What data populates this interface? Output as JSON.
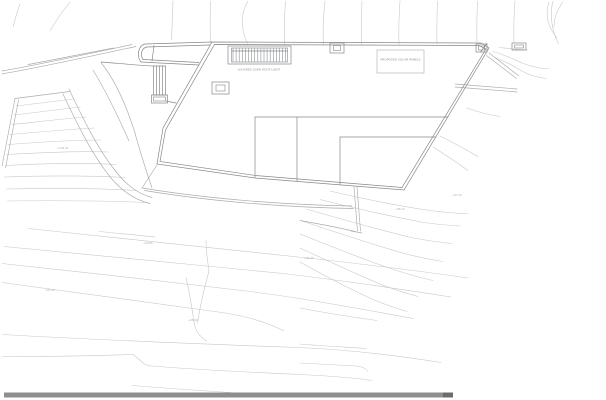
{
  "page": {
    "background": "#ffffff"
  },
  "colors": {
    "line_light": "#c6c8ca",
    "line_medium": "#a9acae",
    "line_dark": "#85888a",
    "text": "#8f9294",
    "scale_bar": "#8d8f8e",
    "scale_bar_end": "#6b6d6c"
  },
  "labels": {
    "louver_caption": "LOUVRES OVER ROOF LIGHT",
    "panel_label": "PROPOSED SOLAR PANELS",
    "levels": [
      {
        "x": 57,
        "y": 149,
        "t": "+104.20"
      },
      {
        "x": 143,
        "y": 244,
        "t": "+99.80"
      },
      {
        "x": 45,
        "y": 291,
        "t": "+97.20"
      },
      {
        "x": 188,
        "y": 321,
        "t": "+95.60"
      },
      {
        "x": 304,
        "y": 259,
        "t": "+96.40"
      },
      {
        "x": 452,
        "y": 196,
        "t": "+97.50"
      },
      {
        "x": 395,
        "y": 210,
        "t": "+98.10"
      }
    ]
  },
  "scale_bar": {
    "x": 4,
    "y": 392.5,
    "w": 449,
    "h": 5,
    "end_w": 10
  },
  "drawing": {
    "width": 606,
    "height": 400,
    "layers": [
      {
        "name": "contour-line",
        "color": "line_light",
        "width": 0.6,
        "paths": [
          "M20,4 C17,12 15,19.5 13,27",
          "M70,2 C62,12 55,22 50,31",
          "M173,1 C172.5,14 172,27 171.5,40",
          "M210.5,1 C210,14.5 210,28.5 210.5,42",
          "M248,1 C240.5,13 240.5,29 247.5,43.5",
          "M285.5,1 C284.5,15 284,29.5 284.5,44",
          "M325,1 C323.5,15 322.5,30 323.5,44.5",
          "M362,1 C361.5,15 361,30 361.5,44.5",
          "M400,1 C399,15 398.5,30 399,44.5",
          "M437.5,1 C437,15 436.5,29 437,43.5",
          "M477.5,1 C477,14 476.5,27.5 477,42",
          "M515,1 C514,14 513.5,27 514,42.5",
          "M553,1 C549.5,14 551.5,30 558.5,44",
          "M549,2 C545,13 547,26 557,38",
          "M563,2 C557,10 554,18 554,27",
          "M16,106 C34,104 54,101.5 74,99",
          "M14,115 C36,112.5 58,109.5 80,107",
          "M12,124.5 C36,122 61,119 86,117",
          "M10,134.5 C38,132 67,129.5 94,128",
          "M8,144.5 C41,142 73,140 101,140",
          "M6.5,154.5 C42,152.5 78,151 108,152",
          "M5,165.5 C44,163.5 82,162.5 116,164.5",
          "M4,177 C48,175.5 90,175.5 125,177.5",
          "M6,189 C52,188 97,188 135,190.5",
          "M7.5,201 C55,200.5 102,200.5 147,202.5",
          "M99,231.5 C119,233.5 138,235 155,237",
          "M28,228.5 C110,238 200,247 298,257 C358,263.5 420,271 468,278",
          "M4,246.5 C92,255.5 190,264 283,273.5 C343,280.5 403,289.5 451,297",
          "M2,263.5 C82,272 168,281.5 246,291 C300,297.5 360,309 414,318.5",
          "M2,282.5 C72,292 150,302.5 222,312.5 C248,316.5 268,322.5 284,331",
          "M2,334.5 C100,340 200,344 298,347.5 C350,349.5 400,356 441,362.5",
          "M2,356.5 C55,356.5 105,355.5 133,354.5 C141,359.5 142,365.5 152,366 C200,370 255,372.5 300,374.5 C330,376 356,378 372,380.5",
          "M132,385.5 C195,390.5 252,394 306,397",
          "M206,240.5 C206,251 207.5,261 209,271",
          "M186,277.5 C190,294 192,309 194,322",
          "M209,271 C203.5,291 199.5,309.5 197.5,323",
          "M194,322 C195,330 199,336.5 207,341",
          "M330,191 C362,198.5 396,205.5 430,210.5 C446,212.5 459,213.5 468,213.5",
          "M320,199.5 C356,208.5 391,216.5 424,222.5 C438,224.5 451,225.5 460,226",
          "M306,209 C341,219 378,229.5 411,237.5 C427,240.5 441,242.5 452,243.5",
          "M302,221 C335,232 368,243 399,252 C415,256.5 430,259.5 443,261.5",
          "M300,234 C330,246 360,258 389,268 C404,273 419,277.5 433,280.5",
          "M300,248 C328,261 355,273.5 381,284.5 C394,289.5 407,293.5 418,296.5",
          "M300,262 C325,276 349,288.5 373,299.5 C385,304.5 397,308.5 407,311.5",
          "M300,308 C326,313 351,317 377,320.5",
          "M300,344 C322,346 344,347 366,348.5",
          "M300,363 C320,364 339,365 356,366 C362,366.5 366,368.5 368,371.5",
          "M493,51.5 C504,54.5 514,59.5 522,63 C531,66.5 541,68.5 549,69",
          "M495,57.5 C505,61.5 513,65.5 520,70 C528,74.5 537,77.5 546,78.5",
          "M499,47.5 C509,48.5 518,49.5 528,50",
          "M440,136 C452,142 465,149 478,156.5",
          "M433,147 C445,154.5 457,162.5 468,170.5",
          "M467,108 C478,112 489,115 500,116.5"
        ]
      },
      {
        "name": "site-line",
        "color": "line_medium",
        "width": 0.65,
        "paths": [
          "M2,74 C42,67 92,56 136,46.5",
          "M2,71 C42,64 90,53.5 132,44.5",
          "M28,64.5 C56,59.5 86,53 114,48",
          "M101,62.5 C114,79 126,104 135,133",
          "M93,70 C104,88 117,114 129,141",
          "M135,133 C140,152 146,170 152,188",
          "M69,89 C80,112 96,147 117,173 C127,185.5 139,194 152,197.5",
          "M63,94 C74,117 90,152 111,178 C122,191 135,200 150,203.5",
          "M15,98.5 L2,166",
          "M18.5,100 L5.5,168",
          "M15,98.5 C34,96 53,93.5 70,91.5",
          "M157,165 L142,188",
          "M142,188 C212,199.5 290,205 352,206",
          "M144.5,190.5 C214,202 291,207.5 353.5,208.5",
          "M354,187 L357.5,231",
          "M357,187 L360.5,231",
          "M300,220.5 C325,225 343,228.5 355,231.5",
          "M351,231 L362,233",
          "M489,53 L519,76",
          "M486.5,55.5 L516.5,78.5",
          "M455,84 L517,89",
          "M455,87 L517,92"
        ]
      },
      {
        "name": "building-line",
        "color": "line_dark",
        "width": 0.7,
        "paths": [
          "M212,42 L481,43 L489,48 L404,190 L255,178 L157,164 L163,128 Z",
          "M214.5,44.5 L479,45.5 L486,49 L402,187.5 L255.5,175.5 L160,161.5 L165.5,130 Z",
          "M255,117 L448,117",
          "M255,117 L255,177.5",
          "M297,117 L297,181",
          "M340,137 L436,137",
          "M340,137 L340,184.5",
          "M145,44 L212,42",
          "M146.5,47 L210,45",
          "M141,62 L199,65",
          "M143,59.5 L199,62.5",
          "M145,44 C138.5,45.5 136,55.5 141,62",
          "M146.5,47 C141.5,48.5 140,54.5 143,59.5",
          "M154,45.5 L152,61",
          "M153.5,66 C140,65.5 120,63.5 101,62",
          "M153.5,66 L153.5,95",
          "M156.5,66 L156.5,95",
          "M159.5,66 L159.5,95",
          "M162.5,66 L162.5,95",
          "M165.5,66 L165.5,95",
          "M153.5,66 L165.5,66",
          "M153.5,95 L165.5,95",
          "M166,101 L176,103",
          "M487,43.5 L480.5,52",
          "M231.5,51 L287.5,51"
        ]
      }
    ],
    "rects": [
      {
        "name": "louver-box-outer",
        "x": 228,
        "y": 46,
        "w": 63,
        "h": 18,
        "color": "line_dark",
        "width": 0.7
      },
      {
        "name": "louver-box-inner",
        "x": 231.5,
        "y": 48,
        "w": 56,
        "h": 14,
        "color": "line_dark",
        "width": 0.6
      },
      {
        "name": "roof-vent-outer",
        "x": 212,
        "y": 82,
        "w": 17,
        "h": 12,
        "color": "line_dark",
        "width": 0.7
      },
      {
        "name": "roof-vent-inner",
        "x": 216,
        "y": 85,
        "w": 9,
        "h": 6,
        "color": "line_dark",
        "width": 0.6
      },
      {
        "name": "top-edge-box-outer",
        "x": 330,
        "y": 43,
        "w": 14,
        "h": 10,
        "color": "line_dark",
        "width": 0.7
      },
      {
        "name": "top-edge-box-inner",
        "x": 333.5,
        "y": 45.5,
        "w": 7,
        "h": 5,
        "color": "line_dark",
        "width": 0.6
      },
      {
        "name": "corner-box-outer",
        "x": 476,
        "y": 44,
        "w": 11,
        "h": 8,
        "color": "line_dark",
        "width": 0.7
      },
      {
        "name": "corner-box-inner",
        "x": 478.5,
        "y": 46,
        "w": 6,
        "h": 4,
        "color": "line_dark",
        "width": 0.6
      },
      {
        "name": "right-box-outer",
        "x": 512,
        "y": 43,
        "w": 14,
        "h": 7,
        "color": "line_dark",
        "width": 0.7
      },
      {
        "name": "right-box-inner",
        "x": 514.5,
        "y": 45,
        "w": 9,
        "h": 3,
        "color": "line_dark",
        "width": 0.6
      },
      {
        "name": "panel-label-box",
        "x": 377,
        "y": 50,
        "w": 47,
        "h": 23,
        "color": "line_medium",
        "width": 0.6
      },
      {
        "name": "stair-landing-outer",
        "x": 151.5,
        "y": 95,
        "w": 16,
        "h": 8,
        "color": "line_dark",
        "width": 0.7
      },
      {
        "name": "stair-landing-inner",
        "x": 153.5,
        "y": 97,
        "w": 12,
        "h": 4,
        "color": "line_dark",
        "width": 0.6
      }
    ],
    "louver_hatch": {
      "x": 233,
      "y1": 48,
      "y2": 62,
      "count": 18,
      "step": 3.1
    },
    "texts": [
      {
        "name": "louver-caption",
        "bind": "louver_caption",
        "x": 259,
        "y": 70.5,
        "size": 3,
        "anchor": "middle"
      },
      {
        "name": "panel-label",
        "bind": "panel_label",
        "x": 400.5,
        "y": 60.5,
        "size": 3,
        "anchor": "middle"
      }
    ]
  }
}
